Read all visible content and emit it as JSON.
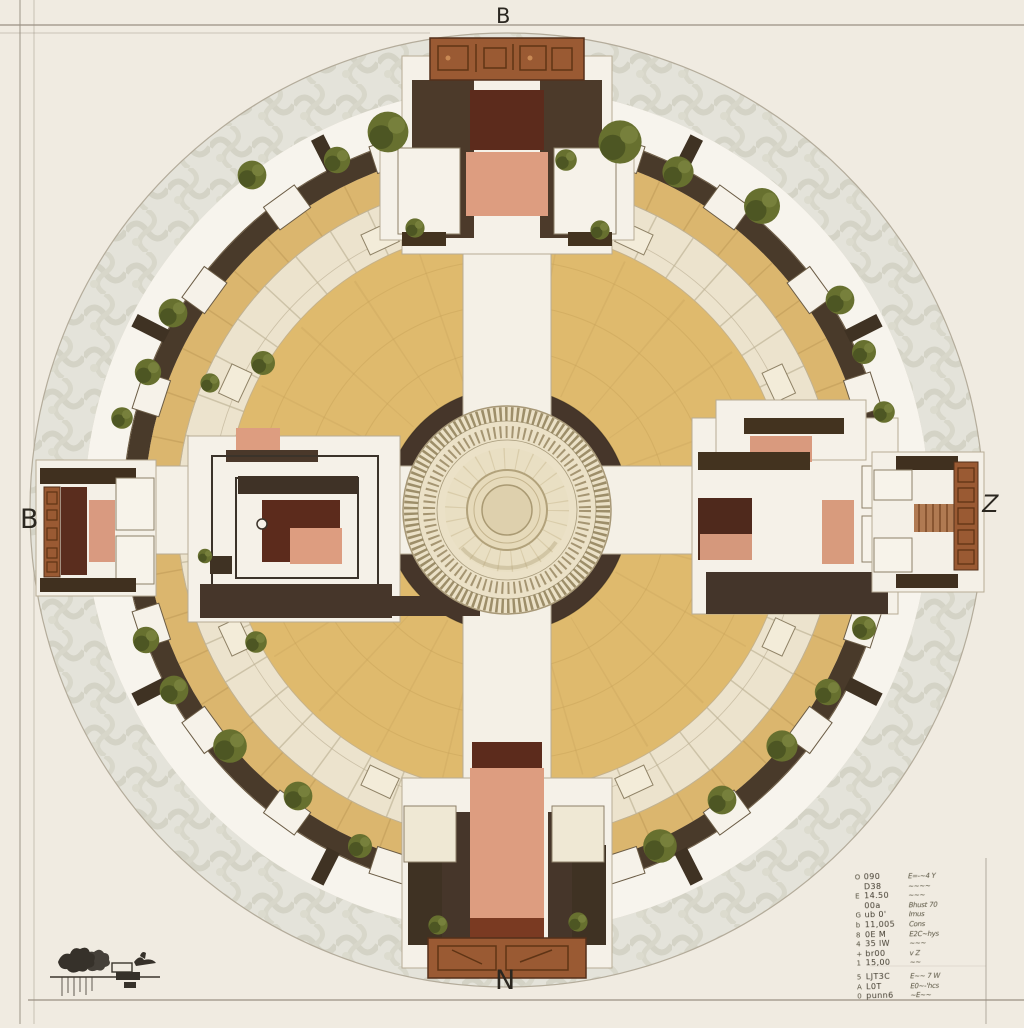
{
  "drawing": {
    "type": "architectural-plan",
    "labels": {
      "top": "B",
      "left": "B",
      "right": "Z",
      "bottom": "N"
    }
  },
  "legend": {
    "items": [
      {
        "mark": "O",
        "code": "090",
        "desc": "E=-~4 Y"
      },
      {
        "mark": "",
        "code": "D38",
        "desc": "~~~~"
      },
      {
        "mark": "E",
        "code": "14.50",
        "desc": "~~~"
      },
      {
        "mark": "",
        "code": "00a",
        "desc": "Bhust 70"
      },
      {
        "mark": "G",
        "code": "ub 0'",
        "desc": "Imus"
      },
      {
        "mark": "b",
        "code": "11,005",
        "desc": "Cons"
      },
      {
        "mark": "8",
        "code": "0E M",
        "desc": "E2C~hys"
      },
      {
        "mark": "4",
        "code": "35 lW",
        "desc": "~~~"
      },
      {
        "mark": "+",
        "code": "br00",
        "desc": "v Z"
      },
      {
        "mark": "1",
        "code": "15,00",
        "desc": "~~"
      },
      {
        "mark": "5",
        "code": "LJT3C",
        "desc": "E~~ 7 W"
      },
      {
        "mark": "A",
        "code": "L0T",
        "desc": "E0~-'hcs"
      },
      {
        "mark": "0",
        "code": "punn6",
        "desc": "~E~~"
      }
    ]
  },
  "palette": {
    "paper": "#f0ebe1",
    "arabesque_ring": "#e4e3da",
    "arabesque_line": "#d2d1c4",
    "white_ring": "#f7f4ed",
    "dark_wall": "#493a2a",
    "tan_ring": "#dbb66e",
    "cream_band": "#ece3cd",
    "courtyard": "#dfba6d",
    "joint_line": "#c8a35c",
    "salmon": "#dd9d80",
    "maroon": "#5c2b1c",
    "copper_carving": "#9a5a33",
    "copper_dark": "#54301a",
    "tree_green": "#67702f",
    "ink": "#2f2b24",
    "pencil": "#9a9183"
  }
}
